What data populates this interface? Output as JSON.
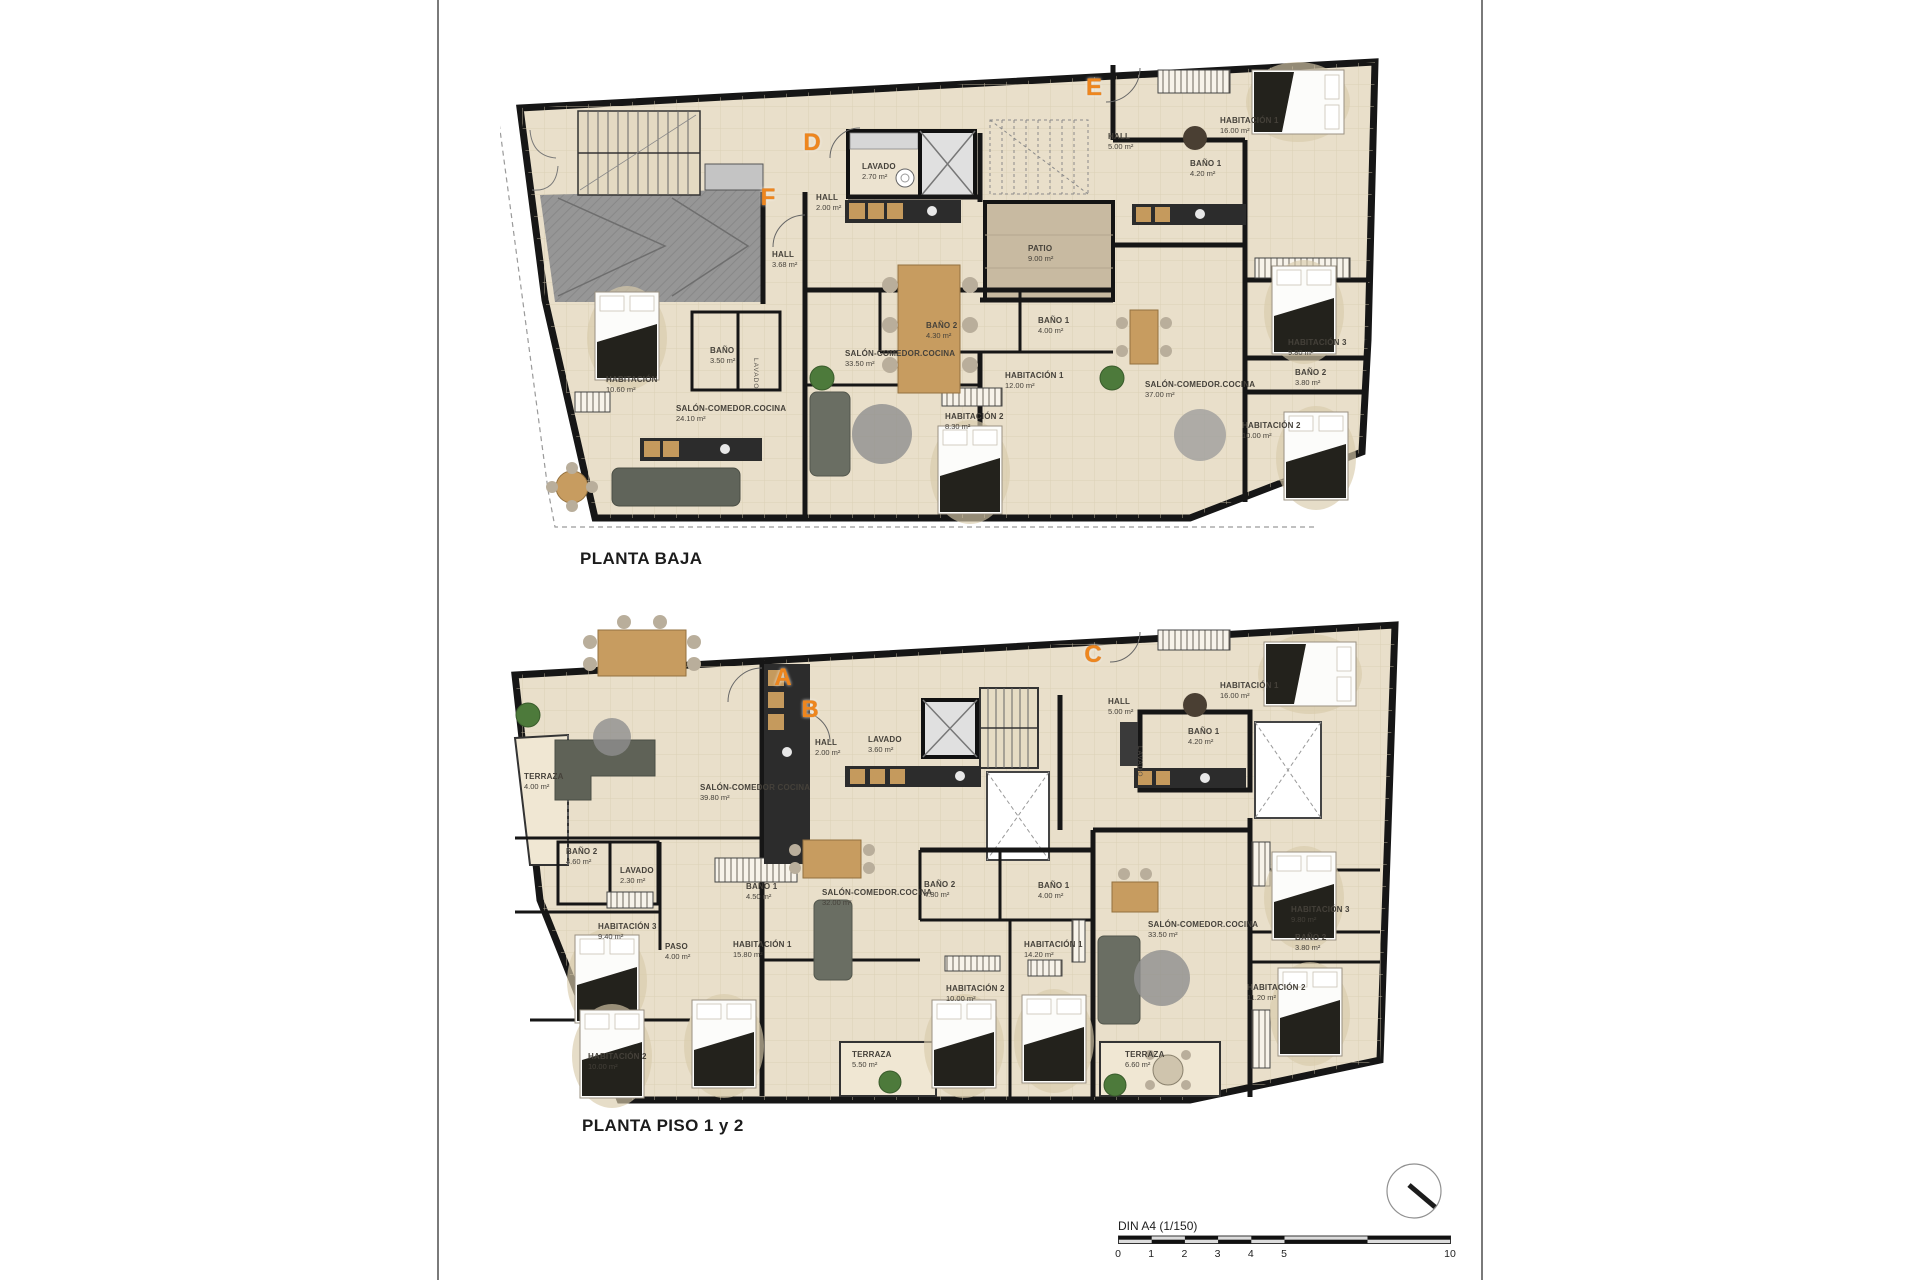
{
  "sheet": {
    "scale_bar": {
      "label": "DIN A4 (1/150)",
      "ticks": [
        {
          "label": "0",
          "u": 0
        },
        {
          "label": "1",
          "u": 1
        },
        {
          "label": "2",
          "u": 2
        },
        {
          "label": "3",
          "u": 3
        },
        {
          "label": "4",
          "u": 4
        },
        {
          "label": "5",
          "u": 5
        },
        {
          "label": "10",
          "u": 10
        }
      ]
    },
    "colors": {
      "accent_orange": "#ee861e",
      "wall": "#161616",
      "floor": "#e9dfca",
      "garage": "#969696",
      "patio": "#c8baa1",
      "terrace": "#f0e7d3"
    }
  },
  "plans": [
    {
      "id": "planta-baja",
      "title": "PLANTA BAJA",
      "letters": [
        {
          "t": "F",
          "x": 268,
          "y": 158
        },
        {
          "t": "D",
          "x": 312,
          "y": 103
        },
        {
          "t": "E",
          "x": 594,
          "y": 48
        }
      ],
      "rooms": [
        {
          "name": "HALL",
          "area": "3.68 m²",
          "x": 272,
          "y": 210
        },
        {
          "name": "BAÑO",
          "area": "3.50 m²",
          "x": 210,
          "y": 306
        },
        {
          "name": "HABITACIÓN",
          "area": "10.60 m²",
          "x": 106,
          "y": 335
        },
        {
          "name": "SALÓN-COMEDOR.COCINA",
          "area": "24.10 m²",
          "x": 176,
          "y": 364
        },
        {
          "name": "LAVADO",
          "area": "2.70 m²",
          "x": 362,
          "y": 122
        },
        {
          "name": "HALL",
          "area": "2.00 m²",
          "x": 316,
          "y": 153
        },
        {
          "name": "SALÓN-COMEDOR.COCINA",
          "area": "33.50 m²",
          "x": 345,
          "y": 309
        },
        {
          "name": "BAÑO 2",
          "area": "4.30 m²",
          "x": 426,
          "y": 281
        },
        {
          "name": "BAÑO 1",
          "area": "4.00 m²",
          "x": 538,
          "y": 276
        },
        {
          "name": "HABITACIÓN 1",
          "area": "12.00 m²",
          "x": 505,
          "y": 331
        },
        {
          "name": "HABITACIÓN 2",
          "area": "8.30 m²",
          "x": 445,
          "y": 372
        },
        {
          "name": "HALL",
          "area": "5.00 m²",
          "x": 608,
          "y": 92
        },
        {
          "name": "HABITACIÓN 1",
          "area": "16.00 m²",
          "x": 720,
          "y": 76
        },
        {
          "name": "BAÑO 1",
          "area": "4.20 m²",
          "x": 690,
          "y": 119
        },
        {
          "name": "PATIO",
          "area": "9.00 m²",
          "x": 528,
          "y": 204
        },
        {
          "name": "HABITACIÓN 3",
          "area": "9.80 m²",
          "x": 788,
          "y": 298
        },
        {
          "name": "BAÑO 2",
          "area": "3.80 m²",
          "x": 795,
          "y": 328
        },
        {
          "name": "HABITACIÓN 2",
          "area": "10.00 m²",
          "x": 742,
          "y": 381
        },
        {
          "name": "SALÓN-COMEDOR.COCINA",
          "area": "37.00 m²",
          "x": 645,
          "y": 340
        }
      ],
      "vlabels": [
        {
          "t": "LAVADO",
          "x": 252,
          "y": 318
        }
      ]
    },
    {
      "id": "planta-piso-1-y-2",
      "title": "PLANTA PISO 1 y 2",
      "letters": [
        {
          "t": "A",
          "x": 283,
          "y": 78
        },
        {
          "t": "B",
          "x": 310,
          "y": 110
        },
        {
          "t": "C",
          "x": 593,
          "y": 55
        }
      ],
      "rooms": [
        {
          "name": "TERRAZA",
          "area": "4.00 m²",
          "x": 24,
          "y": 172
        },
        {
          "name": "SALÓN-COMEDOR COCINA",
          "area": "39.80 m²",
          "x": 200,
          "y": 183
        },
        {
          "name": "BAÑO 2",
          "area": "4.60 m²",
          "x": 66,
          "y": 247
        },
        {
          "name": "LAVADO",
          "area": "2.30 m²",
          "x": 120,
          "y": 266
        },
        {
          "name": "HABITACIÓN 3",
          "area": "9.40 m²",
          "x": 98,
          "y": 322
        },
        {
          "name": "PASO",
          "area": "4.00 m²",
          "x": 165,
          "y": 342
        },
        {
          "name": "HABITACIÓN 1",
          "area": "15.80 m²",
          "x": 233,
          "y": 340
        },
        {
          "name": "BAÑO 1",
          "area": "4.50 m²",
          "x": 246,
          "y": 282
        },
        {
          "name": "HABITACIÓN 2",
          "area": "10.00 m²",
          "x": 88,
          "y": 452
        },
        {
          "name": "HALL",
          "area": "2.00 m²",
          "x": 315,
          "y": 138
        },
        {
          "name": "LAVADO",
          "area": "3.60 m²",
          "x": 368,
          "y": 135
        },
        {
          "name": "SALÓN-COMEDOR.COCINA",
          "area": "32.00 m²",
          "x": 322,
          "y": 288
        },
        {
          "name": "BAÑO 2",
          "area": "4.30 m²",
          "x": 424,
          "y": 280
        },
        {
          "name": "BAÑO 1",
          "area": "4.00 m²",
          "x": 538,
          "y": 281
        },
        {
          "name": "HABITACIÓN 1",
          "area": "14.20 m²",
          "x": 524,
          "y": 340
        },
        {
          "name": "HABITACIÓN 2",
          "area": "10.00 m²",
          "x": 446,
          "y": 384
        },
        {
          "name": "TERRAZA",
          "area": "5.50 m²",
          "x": 352,
          "y": 450
        },
        {
          "name": "HALL",
          "area": "5.00 m²",
          "x": 608,
          "y": 97
        },
        {
          "name": "HABITACIÓN 1",
          "area": "16.00 m²",
          "x": 720,
          "y": 81
        },
        {
          "name": "BAÑO 1",
          "area": "4.20 m²",
          "x": 688,
          "y": 127
        },
        {
          "name": "SALÓN-COMEDOR.COCINA",
          "area": "33.50 m²",
          "x": 648,
          "y": 320
        },
        {
          "name": "HABITACIÓN 3",
          "area": "9.80 m²",
          "x": 791,
          "y": 305
        },
        {
          "name": "BAÑO 2",
          "area": "3.80 m²",
          "x": 795,
          "y": 333
        },
        {
          "name": "HABITACIÓN 2",
          "area": "11.20 m²",
          "x": 747,
          "y": 383
        },
        {
          "name": "TERRAZA",
          "area": "6.60 m²",
          "x": 625,
          "y": 450
        }
      ],
      "vlabels": [
        {
          "t": "LAVADO",
          "x": 636,
          "y": 146
        }
      ]
    }
  ]
}
